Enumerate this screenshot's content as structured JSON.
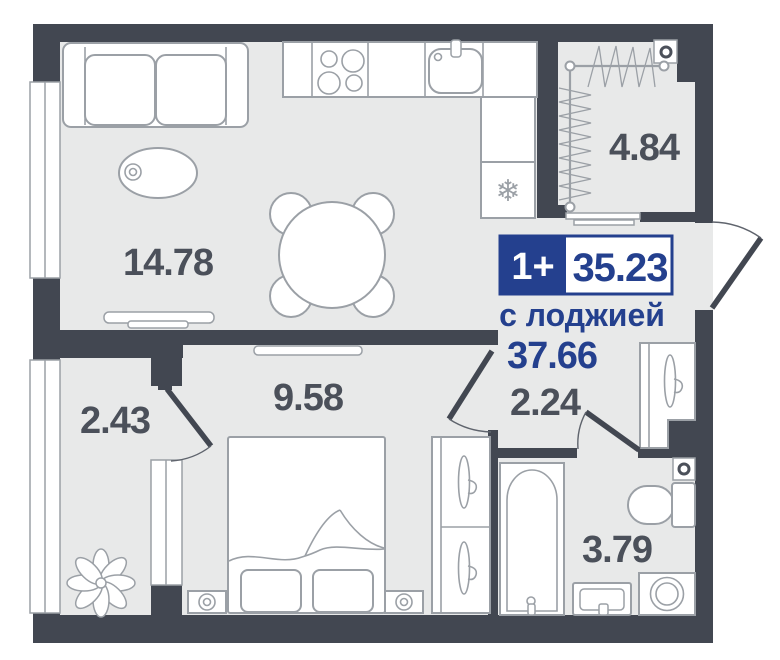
{
  "plan": {
    "badge": {
      "type": "1+",
      "area": "35.23"
    },
    "with_loggia_label": "с лоджией",
    "with_loggia_area": "37.66",
    "rooms": [
      {
        "name": "living-kitchen",
        "area": "14.78"
      },
      {
        "name": "drying-loggia",
        "area": "4.84"
      },
      {
        "name": "loggia",
        "area": "2.43"
      },
      {
        "name": "bedroom",
        "area": "9.58"
      },
      {
        "name": "hallway",
        "area": "2.24"
      },
      {
        "name": "bathroom",
        "area": "3.79"
      }
    ],
    "icons": {
      "fridge_snowflake": "❄"
    },
    "colors": {
      "wall": "#424751",
      "floor": "#e8e9e9",
      "line": "#9ba0a6",
      "accent": "#24408e",
      "label": "#4b505a",
      "arc": "#5f646d",
      "bg": "#ffffff"
    }
  }
}
